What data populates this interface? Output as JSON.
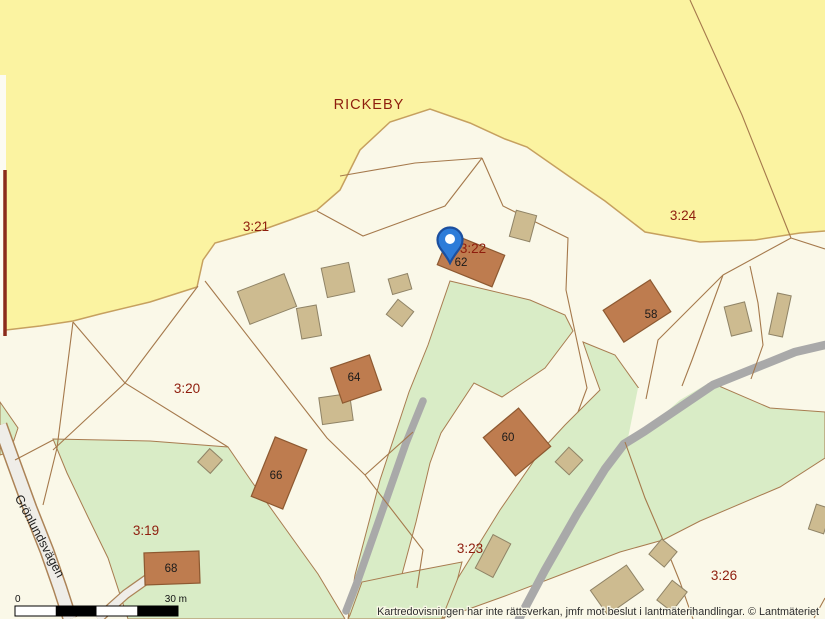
{
  "area": {
    "name": "RICKEBY"
  },
  "parcels": [
    {
      "id": "3:21"
    },
    {
      "id": "3:24"
    },
    {
      "id": "3:22"
    },
    {
      "id": "3:20"
    },
    {
      "id": "3:19"
    },
    {
      "id": "3:23"
    },
    {
      "id": "3:26"
    }
  ],
  "buildings": [
    {
      "number": "62"
    },
    {
      "number": "58"
    },
    {
      "number": "64"
    },
    {
      "number": "66"
    },
    {
      "number": "60"
    },
    {
      "number": "68"
    }
  ],
  "road": {
    "name": "Grönlundsvägen"
  },
  "scale_bar": {
    "start_label": "0",
    "end_label": "30 m"
  },
  "footer": {
    "disclaimer": "Kartredovisningen har inte rättsverkan, jmfr mot beslut i lantmäterihandlingar. © Lantmäteriet"
  },
  "marker": {
    "type": "location-pin"
  },
  "colors": {
    "open_land_yellow": "#FBF3A1",
    "base_cream": "#FAF8E8",
    "vegetation_green": "#D9ECC6",
    "residential_building": "#BE7C4F",
    "outbuilding": "#CDBB90",
    "boundary_line": "#A5794C",
    "parcel_label": "#8E1D0D",
    "pin_blue": "#2E7CD9"
  }
}
